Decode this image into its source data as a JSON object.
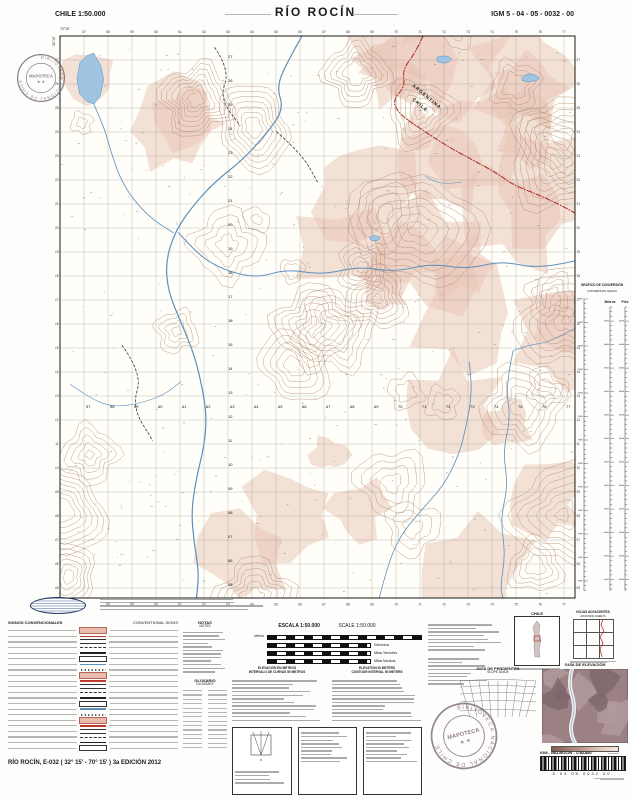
{
  "header": {
    "country_scale": "CHILE  1:50.000",
    "title": "RÍO ROCÍN",
    "sheet_code": "IGM 5 - 04 - 05 - 0032 - 00"
  },
  "corner": {
    "lon": "70°15'",
    "lat": "32°15'"
  },
  "footer": {
    "sheet_line": "RÍO ROCÍN, E-032 ( 32° 15' - 70° 15' ) 3a EDICIÓN 2012"
  },
  "stamps": {
    "ring_text": "BIBLIOTECA NACIONAL DE CHILE",
    "center_text": "MAPOTECA",
    "stars": "★ ★"
  },
  "conversion": {
    "title": "GRÁFICO DE CONVERSIÓN",
    "subtitle": "CONVERSION GRAPH",
    "col_left": "Metros",
    "col_right": "Pies"
  },
  "legend": {
    "signs_title": "SIGNOS CONVENCIONALES",
    "signs_title_en": "CONVENTIONAL SIGNS",
    "notes_title": "NOTAS",
    "notes_title_en": "NOTES",
    "glossary_title": "GLOSARIO",
    "glossary_title_en": "GLOSSARY",
    "scale_title": "ESCALA 1:50.000",
    "scale_title_en": "SCALE 1:50.000",
    "scalebar_units": [
      "Metros",
      "Kilómetros",
      "Millas Terrestres",
      "Millas Náuticas"
    ],
    "elevation_note": "ELEVACIÓN EN METROS",
    "elevation_note_en": "ELEVATION IN METERS",
    "contour_note": "INTERVALO DE CURVAS 50 METROS",
    "contour_note_en": "CONTOUR INTERVAL 50 METERS",
    "slope_title": "GUÍA DE PENDIENTES",
    "slope_sub": "SLOPE GUIDE",
    "elev_guide_title": "GUÍA DE ELEVACIÓN",
    "elev_guide_sub": "ELEVATION GUIDE",
    "locator_title": "CHILE",
    "adjacent_title": "HOJAS ADYACENTES",
    "adjacent_sub": "ADJOINING SHEETS"
  },
  "barcode": {
    "label": "IGM - RÍO ROCÍN - 1:50.000",
    "digits": "5  04  05  0032  00"
  },
  "map": {
    "border_labels": {
      "argentina": "ARGENTINA",
      "chile": "CHILE"
    },
    "colors": {
      "paper": "#fffef8",
      "contour": "#b28a70",
      "shade": "#e8c4b4",
      "water": "#5b8fbe",
      "lake": "#9fc4e2",
      "border": "#b23329",
      "grid": "#6b6b6b",
      "trail": "#3a3a3a"
    },
    "grid": {
      "spacing": 24,
      "easting_start": 56,
      "northing_top": 27,
      "easting_row_y": 372,
      "northing_col_x": 168
    },
    "rivers": [
      {
        "w": 1.2,
        "pts": [
          [
            0.47,
            0
          ],
          [
            0.445,
            0.04
          ],
          [
            0.42,
            0.09
          ],
          [
            0.435,
            0.13
          ],
          [
            0.4,
            0.175
          ],
          [
            0.355,
            0.22
          ],
          [
            0.3,
            0.26
          ],
          [
            0.26,
            0.3
          ],
          [
            0.225,
            0.345
          ],
          [
            0.205,
            0.4
          ],
          [
            0.21,
            0.455
          ],
          [
            0.235,
            0.51
          ],
          [
            0.26,
            0.565
          ],
          [
            0.275,
            0.62
          ],
          [
            0.285,
            0.675
          ],
          [
            0.28,
            0.73
          ],
          [
            0.265,
            0.785
          ],
          [
            0.255,
            0.845
          ],
          [
            0.26,
            0.9
          ],
          [
            0.27,
            0.955
          ],
          [
            0.265,
            1.0
          ]
        ]
      },
      {
        "w": 1.0,
        "pts": [
          [
            1.0,
            0.4
          ],
          [
            0.93,
            0.415
          ],
          [
            0.86,
            0.4
          ],
          [
            0.79,
            0.415
          ],
          [
            0.72,
            0.405
          ],
          [
            0.65,
            0.42
          ],
          [
            0.58,
            0.41
          ],
          [
            0.51,
            0.425
          ],
          [
            0.44,
            0.415
          ],
          [
            0.385,
            0.43
          ],
          [
            0.33,
            0.42
          ],
          [
            0.285,
            0.4
          ],
          [
            0.255,
            0.375
          ],
          [
            0.23,
            0.35
          ]
        ]
      },
      {
        "w": 0.8,
        "pts": [
          [
            0.065,
            0.12
          ],
          [
            0.085,
            0.16
          ],
          [
            0.1,
            0.21
          ],
          [
            0.12,
            0.26
          ],
          [
            0.15,
            0.3
          ],
          [
            0.185,
            0.33
          ],
          [
            0.22,
            0.35
          ]
        ]
      },
      {
        "w": 0.8,
        "pts": [
          [
            0.62,
            1.0
          ],
          [
            0.635,
            0.945
          ],
          [
            0.66,
            0.89
          ],
          [
            0.7,
            0.845
          ],
          [
            0.745,
            0.8
          ],
          [
            0.775,
            0.745
          ],
          [
            0.79,
            0.69
          ],
          [
            0.8,
            0.635
          ],
          [
            0.795,
            0.58
          ]
        ]
      },
      {
        "w": 0.8,
        "pts": [
          [
            0.88,
            0.56
          ],
          [
            0.865,
            0.62
          ],
          [
            0.875,
            0.68
          ],
          [
            0.86,
            0.74
          ],
          [
            0.87,
            0.8
          ],
          [
            0.855,
            0.86
          ],
          [
            0.865,
            0.92
          ],
          [
            0.855,
            0.98
          ],
          [
            0.86,
            1.0
          ]
        ]
      },
      {
        "w": 0.6,
        "pts": [
          [
            0.78,
            0.26
          ],
          [
            0.74,
            0.265
          ],
          [
            0.71,
            0.25
          ]
        ]
      },
      {
        "w": 0.6,
        "pts": [
          [
            0.02,
            0.62
          ],
          [
            0.06,
            0.645
          ],
          [
            0.1,
            0.66
          ],
          [
            0.15,
            0.655
          ],
          [
            0.2,
            0.64
          ],
          [
            0.235,
            0.615
          ]
        ]
      },
      {
        "w": 0.6,
        "pts": [
          [
            1.0,
            0.52
          ],
          [
            0.95,
            0.545
          ],
          [
            0.91,
            0.55
          ],
          [
            0.88,
            0.56
          ]
        ]
      }
    ],
    "trails": [
      [
        [
          0.3,
          0.02
        ],
        [
          0.33,
          0.06
        ],
        [
          0.31,
          0.11
        ],
        [
          0.35,
          0.16
        ]
      ],
      [
        [
          0.42,
          0.17
        ],
        [
          0.47,
          0.21
        ],
        [
          0.5,
          0.26
        ]
      ],
      [
        [
          0.12,
          0.55
        ],
        [
          0.16,
          0.6
        ],
        [
          0.14,
          0.66
        ],
        [
          0.18,
          0.72
        ]
      ]
    ],
    "lakes": [
      {
        "x": 0.035,
        "y": 0.03,
        "w": 0.048,
        "h": 0.095
      },
      {
        "x": 0.73,
        "y": 0.035,
        "w": 0.03,
        "h": 0.013
      },
      {
        "x": 0.895,
        "y": 0.068,
        "w": 0.035,
        "h": 0.014
      },
      {
        "x": 0.6,
        "y": 0.355,
        "w": 0.022,
        "h": 0.01
      }
    ],
    "border_path": [
      [
        0.705,
        0
      ],
      [
        0.69,
        0.03
      ],
      [
        0.665,
        0.06
      ],
      [
        0.67,
        0.09
      ],
      [
        0.645,
        0.115
      ],
      [
        0.66,
        0.14
      ],
      [
        0.7,
        0.165
      ],
      [
        0.75,
        0.195
      ],
      [
        0.8,
        0.22
      ],
      [
        0.85,
        0.245
      ],
      [
        0.88,
        0.265
      ],
      [
        0.93,
        0.283
      ],
      [
        0.97,
        0.3
      ],
      [
        1.0,
        0.315
      ]
    ]
  }
}
